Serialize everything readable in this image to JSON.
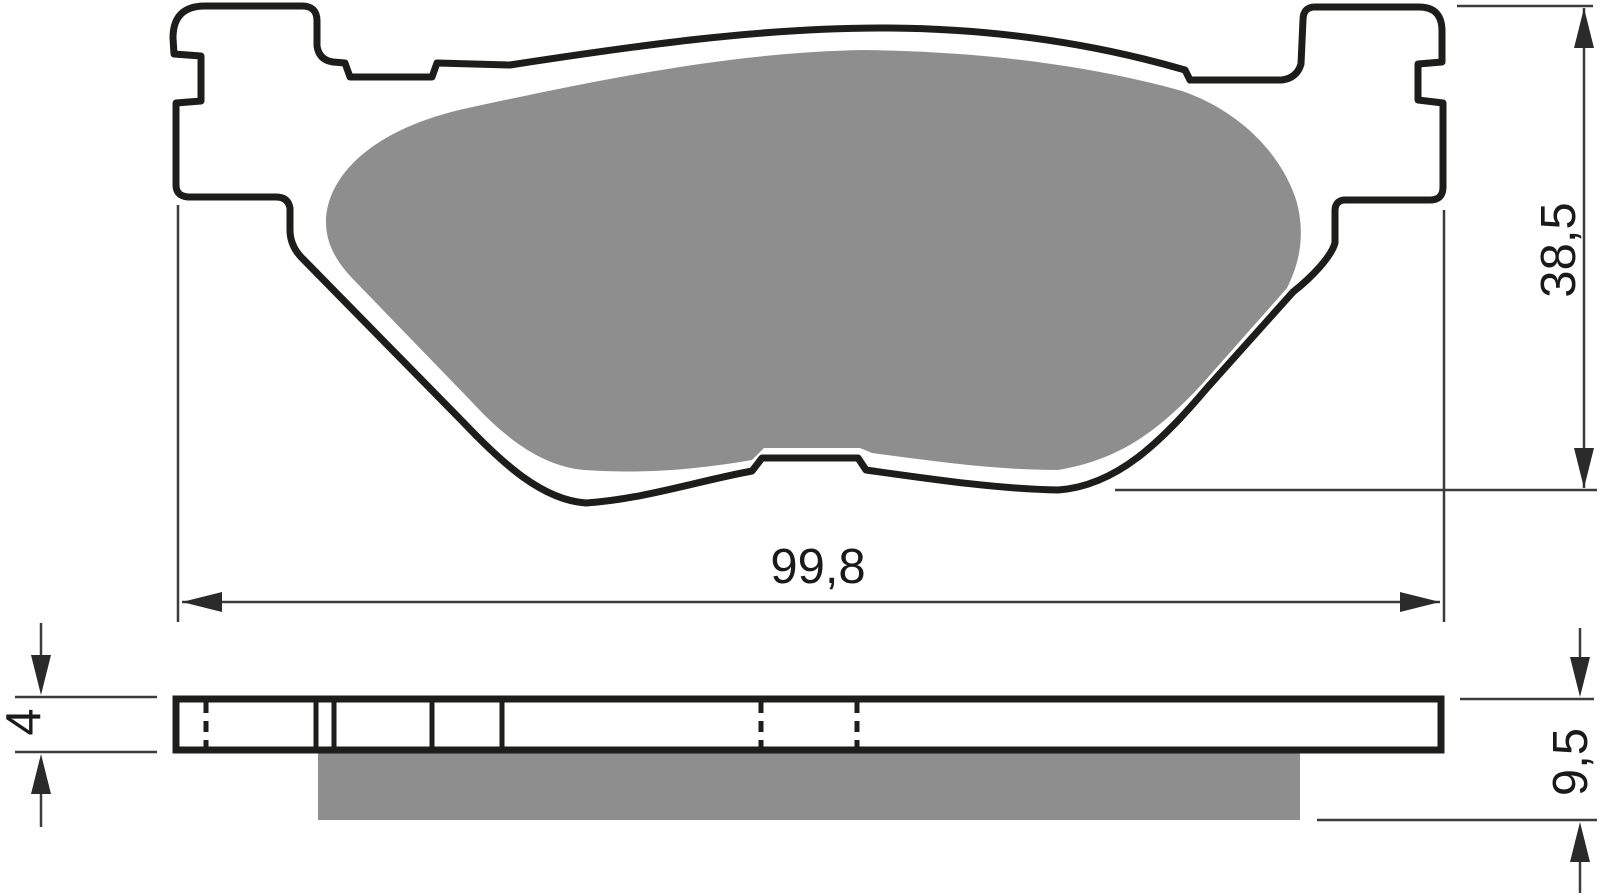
{
  "dimensions": {
    "overall_width": "99,8",
    "overall_height": "38,5",
    "backplate_thickness": "4",
    "total_thickness": "9,5"
  },
  "colors": {
    "outline": "#1d1d1b",
    "friction_material": "#8e8e8e",
    "dimension": "#3c3c3c",
    "background": "#ffffff"
  }
}
